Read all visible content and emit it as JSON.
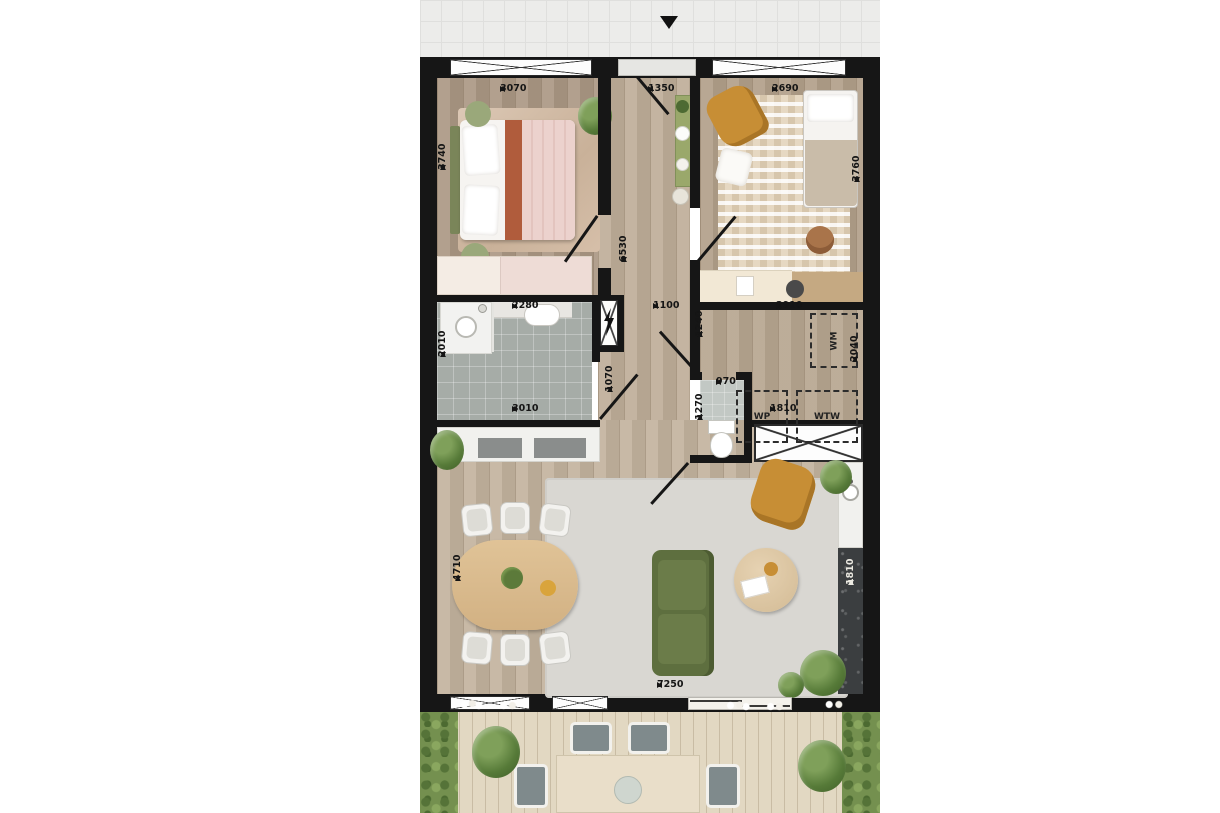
{
  "plan_title": "apartment-floor-plan",
  "entrance": {
    "arrow": "entrance-direction-down"
  },
  "dims": {
    "bedroom1_width": "3070",
    "bedroom1_depth": "3740",
    "hall_width": "1350",
    "bedroom2_width": "2690",
    "bedroom2_depth": "3760",
    "hall_length": "6530",
    "bathroom_width": "2280",
    "bathroom_depth": "2010",
    "bathroom_width_bottom": "3010",
    "bath_door": "1070",
    "hall_lower_width": "1100",
    "hall_lower_depth": "1240",
    "tech_width": "2910",
    "tech_depth": "2040",
    "toilet_width": "970",
    "toilet_depth": "1270",
    "tech_inner_width": "1810",
    "kitchen_length": "1810",
    "living_width": "7250",
    "living_depth": "4710"
  },
  "tech_room": {
    "wm": "WM",
    "wp": "WP",
    "wtw": "WTW"
  },
  "colors": {
    "wall": "#161616",
    "wood_floor": "#bfae99",
    "bathroom_tile": "#a6aca7",
    "deck": "#e2d8c2",
    "sofa_green": "#5e6f3f",
    "armchair_mustard": "#c78e35",
    "kitchen_counter_dark": "#3b3e40",
    "bed_accent_terracotta": "#b05c3c",
    "bed_accent_pink": "#ecd2cd"
  }
}
